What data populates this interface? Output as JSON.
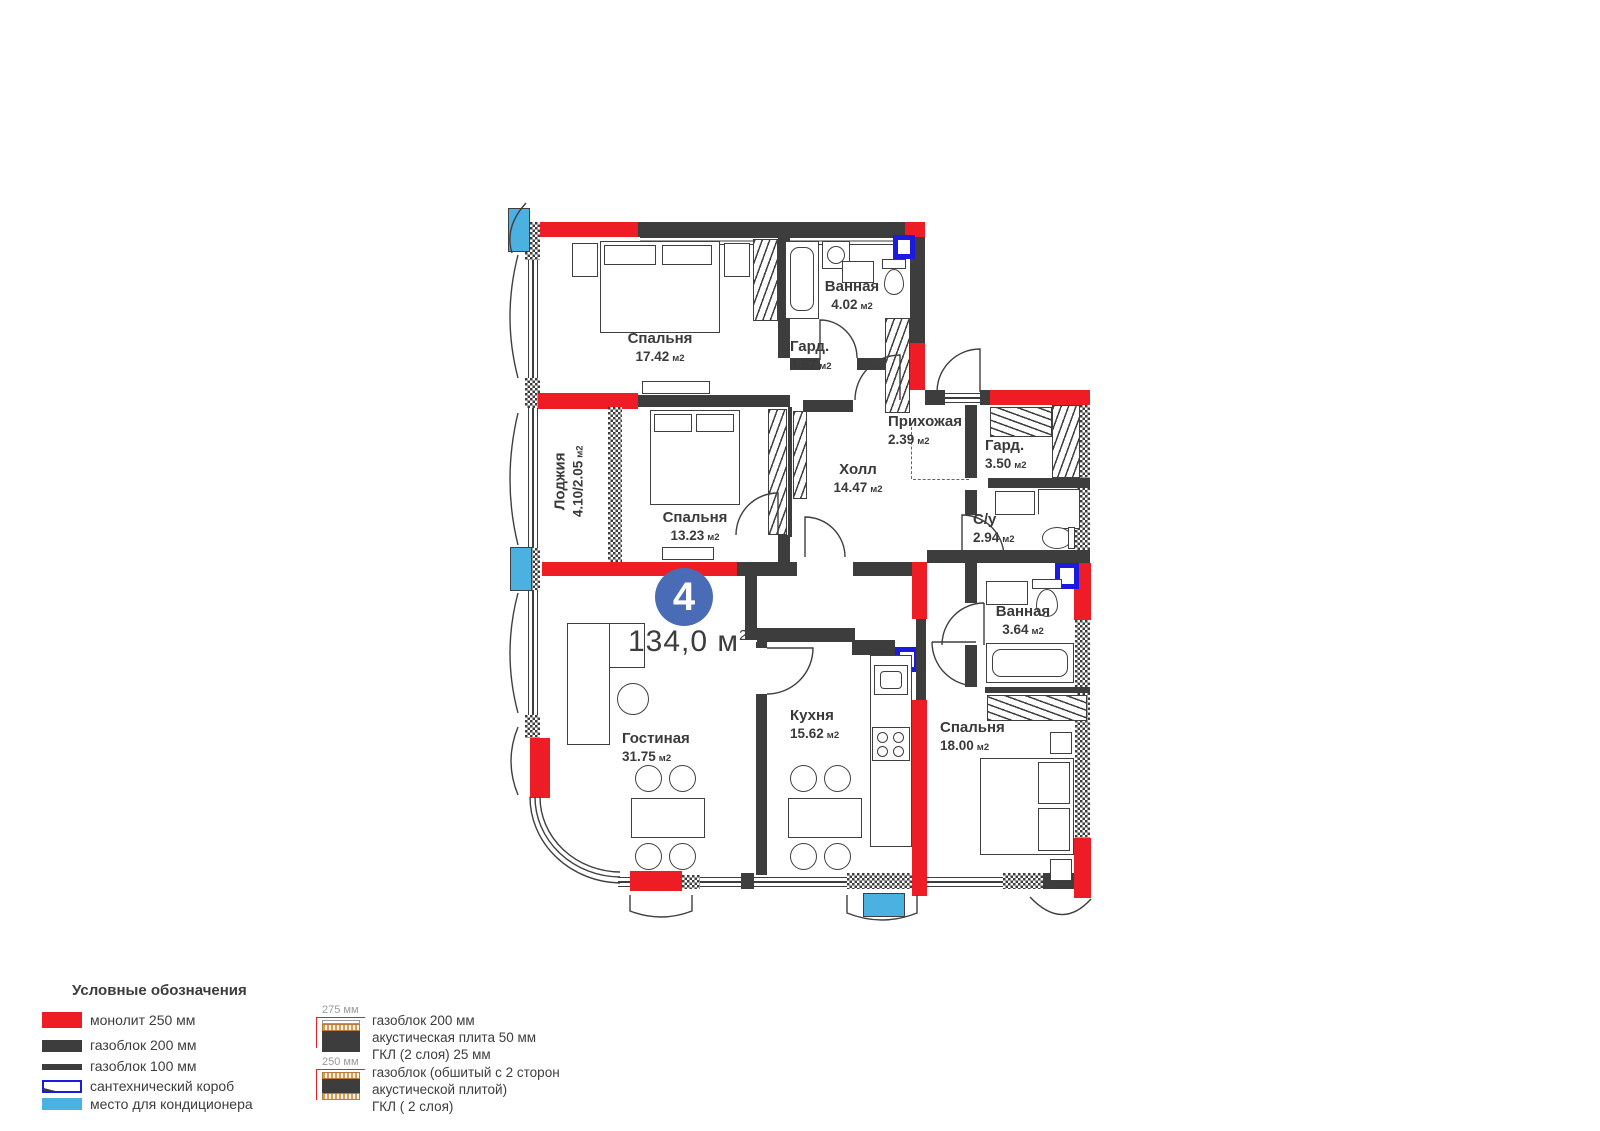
{
  "badge": {
    "number": "4",
    "area": "134,0",
    "unit": "м",
    "sup": "2"
  },
  "rooms": [
    {
      "name": "Спальня",
      "area": "17.42",
      "unit": "м2"
    },
    {
      "name": "Ванная",
      "area": "4.02",
      "unit": "м2"
    },
    {
      "name": "Гард.",
      "area": "4.97",
      "unit": "м2"
    },
    {
      "name": "Прихожая",
      "area": "2.39",
      "unit": "м2"
    },
    {
      "name": "Гард.",
      "area": "3.50",
      "unit": "м2"
    },
    {
      "name": "Холл",
      "area": "14.47",
      "unit": "м2"
    },
    {
      "name": "Лоджия",
      "area": "4.10/2.05",
      "unit": "м2"
    },
    {
      "name": "Спальня",
      "area": "13.23",
      "unit": "м2"
    },
    {
      "name": "С/у",
      "area": "2.94",
      "unit": "м2"
    },
    {
      "name": "Ванная",
      "area": "3.64",
      "unit": "м2"
    },
    {
      "name": "Кухня",
      "area": "15.62",
      "unit": "м2"
    },
    {
      "name": "Гостиная",
      "area": "31.75",
      "unit": "м2"
    },
    {
      "name": "Спальня",
      "area": "18.00",
      "unit": "м2"
    }
  ],
  "legend": {
    "title": "Условные обозначения",
    "items": [
      {
        "label": "монолит 250 мм"
      },
      {
        "label": "газоблок 200 мм"
      },
      {
        "label": "газоблок 100 мм"
      },
      {
        "label": "сантехнический короб"
      },
      {
        "label": "место для кондиционера"
      }
    ],
    "wall_types": [
      {
        "dim": "275 мм",
        "line1": "газоблок 200 мм",
        "line2": "акустическая плита 50 мм",
        "line3": "ГКЛ (2 слоя) 25 мм"
      },
      {
        "dim": "250 мм",
        "line1": "газоблок (обшитый с 2 сторон",
        "line2": "акустической плитой)",
        "line3": "ГКЛ ( 2 слоя)"
      }
    ]
  },
  "colors": {
    "monolith": "#ee1c24",
    "wall": "#3d3d3d",
    "plumbing_box": "#1b1be0",
    "ac_place": "#4bb1e0",
    "badge": "#4a6bb5"
  }
}
